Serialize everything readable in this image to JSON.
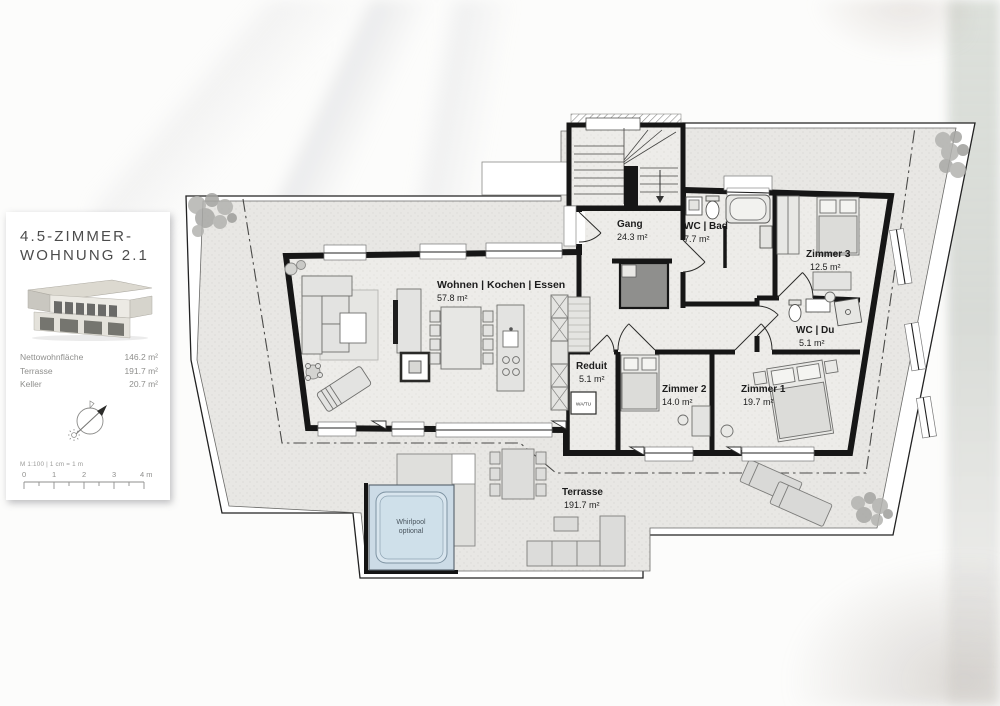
{
  "panel": {
    "title_line1": "4.5-ZIMMER-",
    "title_line2": "WOHNUNG 2.1",
    "stats": [
      {
        "label": "Nettowohnfläche",
        "value": "146.2 m²"
      },
      {
        "label": "Terrasse",
        "value": "191.7 m²"
      },
      {
        "label": "Keller",
        "value": "20.7 m²"
      }
    ],
    "scale_note": "M 1:100 | 1 cm = 1 m",
    "scale_ticks": [
      "0",
      "1",
      "2",
      "3",
      "4 m"
    ]
  },
  "plan": {
    "rooms": [
      {
        "name": "Gang",
        "area": "24.3 m²"
      },
      {
        "name": "WC | Bad",
        "area": "7.7 m²"
      },
      {
        "name": "Zimmer 3",
        "area": "12.5 m²"
      },
      {
        "name": "Wohnen | Kochen | Essen",
        "area": "57.8 m²"
      },
      {
        "name": "Reduit",
        "area": "5.1 m²"
      },
      {
        "name": "WC | Du",
        "area": "5.1 m²"
      },
      {
        "name": "Zimmer 2",
        "area": "14.0 m²"
      },
      {
        "name": "Zimmer 1",
        "area": "19.7 m²"
      },
      {
        "name": "Terrasse",
        "area": "191.7 m²"
      }
    ],
    "whirlpool": {
      "line1": "Whirlpool",
      "line2": "optional"
    },
    "appliance_label": "WA/TU"
  },
  "colors": {
    "wall": "#161616",
    "terrace_floor": "#e8e7e4",
    "room_floor": "#edecе9",
    "whirlpool_fill": "#ccdbe6"
  }
}
